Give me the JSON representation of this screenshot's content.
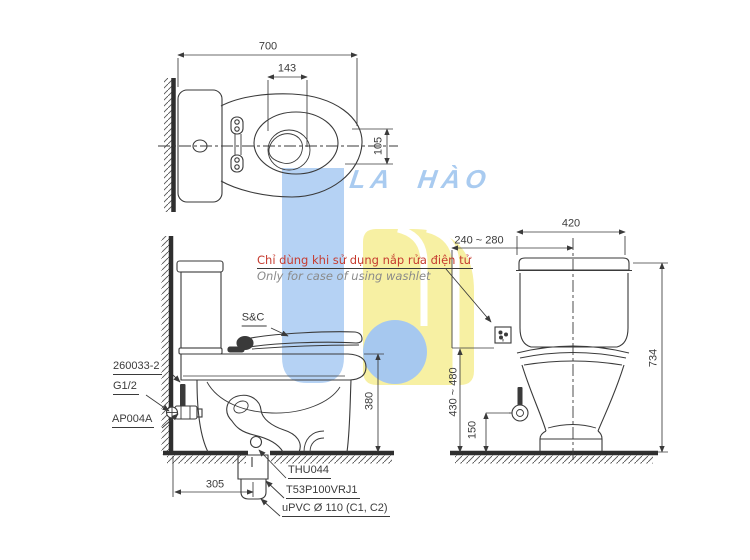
{
  "canvas": {
    "background": "#ffffff",
    "line_color": "#3a3a3a"
  },
  "watermark": {
    "brand": "LA HÀO",
    "brand_color": "#a9cbf0",
    "logo_blue": "#b5d2f4",
    "logo_circle_blue": "#a6c8ef",
    "logo_yellow": "#f7f0a3"
  },
  "note": {
    "vietnamese": "Chỉ dùng khi sử dụng nắp rửa điện tử",
    "english": "Only for case of using washlet",
    "vietnamese_color": "#c63b2f",
    "english_color": "#8a8a8a"
  },
  "top_view": {
    "dim_overall_depth": "700",
    "dim_water_width": "143",
    "dim_water_length": "105"
  },
  "side_view": {
    "label_seat_cover": "S&C",
    "label_supply_pipe": "260033-2",
    "label_thread": "G1/2",
    "label_angle_valve": "AP004A",
    "label_flange": "THU044",
    "label_outlet_joint": "T53P100VRJ1",
    "label_drain_pipe": "uPVC Ø 110 (C1, C2)",
    "dim_seat_height": "380",
    "dim_rough_in": "305"
  },
  "front_view": {
    "dim_width": "420",
    "dim_outlet_offset": "240 ~ 280",
    "dim_total_height": "734",
    "dim_outlet_height": "430 ~ 480",
    "dim_valve_height": "150"
  }
}
